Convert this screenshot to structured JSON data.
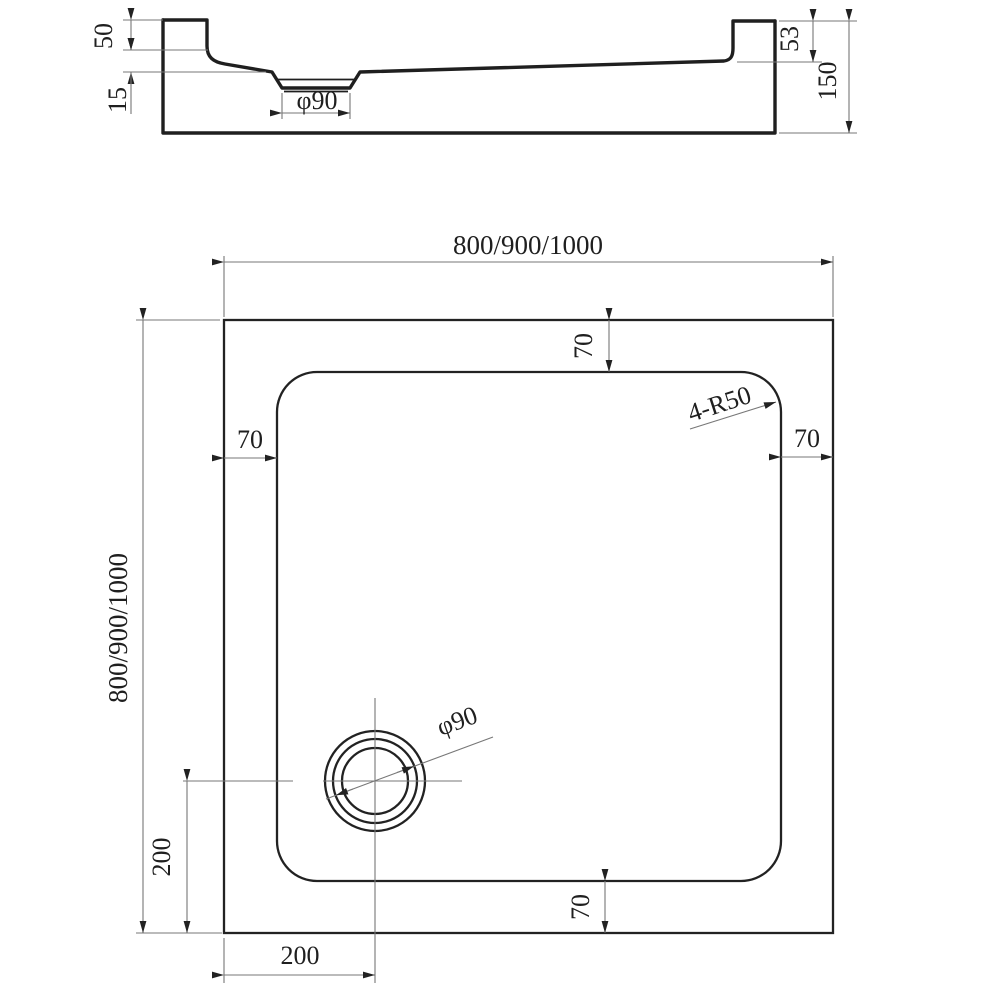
{
  "drawing": {
    "section": {
      "dim_rim_height": "50",
      "dim_floor_depth": "15",
      "dim_drain_diameter": "φ90",
      "dim_inner_rim_height": "53",
      "dim_total_height": "150"
    },
    "plan": {
      "dim_width": "800/900/1000",
      "dim_height": "800/900/1000",
      "dim_edge_top": "70",
      "dim_edge_left": "70",
      "dim_edge_right": "70",
      "dim_edge_bottom": "70",
      "corner_radius_note": "4-R50",
      "dim_drain_diameter": "φ90",
      "dim_drain_offset_vertical": "200",
      "dim_drain_offset_horizontal": "200"
    },
    "colors": {
      "outline": "#1f1f1f",
      "dimension_lines": "#777777",
      "text": "#1f1f1f",
      "background": "#ffffff"
    }
  }
}
